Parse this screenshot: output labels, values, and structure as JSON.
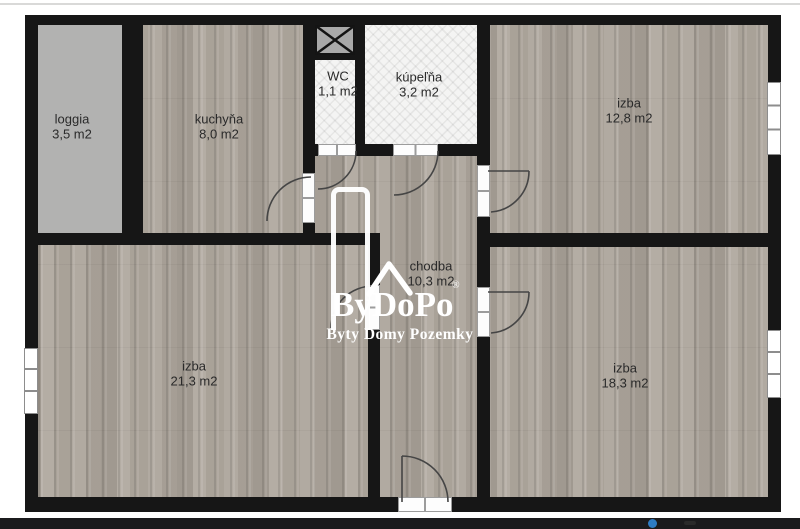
{
  "floorplan": {
    "rooms": [
      {
        "id": "loggia",
        "name": "loggia",
        "area": "3,5 m2"
      },
      {
        "id": "kuchyna",
        "name": "kuchyňa",
        "area": "8,0 m2"
      },
      {
        "id": "wc",
        "name": "WC",
        "area": "1,1 m2"
      },
      {
        "id": "kupelna",
        "name": "kúpeľňa",
        "area": "3,2 m2"
      },
      {
        "id": "izba-top-right",
        "name": "izba",
        "area": "12,8 m2"
      },
      {
        "id": "chodba",
        "name": "chodba",
        "area": "10,3 m2"
      },
      {
        "id": "izba-bottom-left",
        "name": "izba",
        "area": "21,3 m2"
      },
      {
        "id": "izba-bottom-right",
        "name": "izba",
        "area": "18,3 m2"
      }
    ],
    "watermark": {
      "brand": "ByDoPo",
      "registered": "®",
      "tagline": "Byty Domy Pozemky",
      "color": "#ffffff",
      "logo_symbols": [
        "roof-outline-icon",
        "tall-door-outline-icon"
      ]
    },
    "symbols": {
      "shaft_symbol": "x-cross-shaft-icon",
      "door_count": 7,
      "window_count": 3
    },
    "colors": {
      "wall": "#161616",
      "wood_floor": "#aba49b",
      "loggia_floor": "#b2b2b1",
      "tile": "#f4f4f3",
      "shaft_fill": "#a9a9a9",
      "label_text": "#2a2a2a"
    }
  },
  "footer": {
    "bar_color": "#1b1b1d",
    "dot_color": "#2e7cc4"
  }
}
